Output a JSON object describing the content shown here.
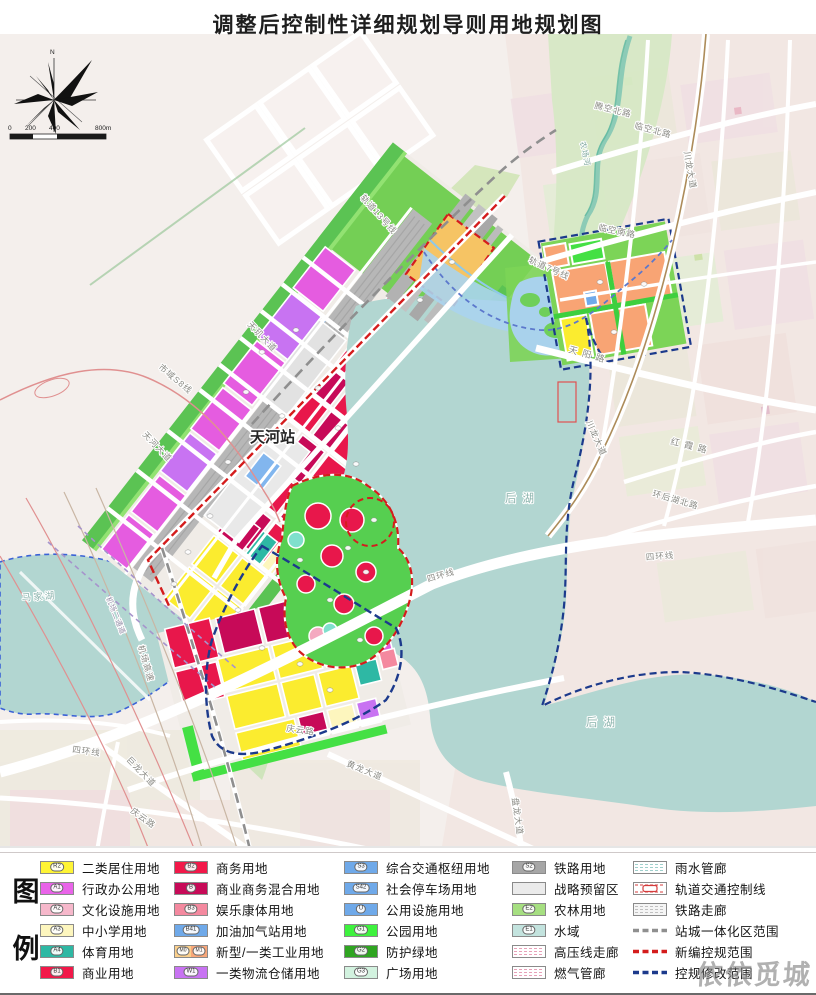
{
  "title": "调整后控制性详细规划导则用地规划图",
  "watermark": "依依觅城",
  "compass": {
    "north": "N"
  },
  "scale": {
    "ticks": [
      "0",
      "200",
      "400",
      "800m"
    ]
  },
  "map": {
    "labels": [
      {
        "t": "N",
        "x": 50,
        "y": 54,
        "r": 0,
        "c": "tick"
      },
      {
        "t": "0",
        "x": 8,
        "y": 130,
        "r": 0,
        "c": "tick"
      },
      {
        "t": "200",
        "x": 25,
        "y": 130,
        "r": 0,
        "c": "tick"
      },
      {
        "t": "400",
        "x": 49,
        "y": 130,
        "r": 0,
        "c": "tick"
      },
      {
        "t": "800m",
        "x": 95,
        "y": 130,
        "r": 0,
        "c": "tick"
      },
      {
        "t": "轨道13号线",
        "x": 360,
        "y": 198,
        "r": 48,
        "c": "road"
      },
      {
        "t": "天玑大道",
        "x": 247,
        "y": 325,
        "r": 46,
        "c": "road"
      },
      {
        "t": "市域S8线",
        "x": 158,
        "y": 368,
        "r": 40,
        "c": "road"
      },
      {
        "t": "天河大道",
        "x": 142,
        "y": 435,
        "r": 46,
        "c": "road"
      },
      {
        "t": "机场二通道",
        "x": 106,
        "y": 598,
        "r": 68,
        "c": "road-sm"
      },
      {
        "t": "机场高速",
        "x": 138,
        "y": 646,
        "r": 74,
        "c": "road"
      },
      {
        "t": "四环线",
        "x": 72,
        "y": 752,
        "r": 8,
        "c": "road"
      },
      {
        "t": "四环线",
        "x": 428,
        "y": 582,
        "r": -16,
        "c": "road"
      },
      {
        "t": "四环线",
        "x": 646,
        "y": 560,
        "r": -4,
        "c": "road"
      },
      {
        "t": "庆云路",
        "x": 286,
        "y": 731,
        "r": 8,
        "c": "road"
      },
      {
        "t": "庆云路",
        "x": 130,
        "y": 812,
        "r": 36,
        "c": "road"
      },
      {
        "t": "巨龙大道",
        "x": 126,
        "y": 760,
        "r": 46,
        "c": "road"
      },
      {
        "t": "黄龙大道",
        "x": 346,
        "y": 766,
        "r": 22,
        "c": "road"
      },
      {
        "t": "盘龙大道",
        "x": 512,
        "y": 798,
        "r": 82,
        "c": "road"
      },
      {
        "t": "腾空北路",
        "x": 594,
        "y": 108,
        "r": 14,
        "c": "road"
      },
      {
        "t": "临空北路",
        "x": 634,
        "y": 128,
        "r": 15,
        "c": "road"
      },
      {
        "t": "临空南路",
        "x": 598,
        "y": 230,
        "r": 12,
        "c": "road"
      },
      {
        "t": "农场河",
        "x": 580,
        "y": 142,
        "r": 78,
        "c": "stream"
      },
      {
        "t": "轨道7号线",
        "x": 528,
        "y": 262,
        "r": 24,
        "c": "road"
      },
      {
        "t": "川龙大道",
        "x": 684,
        "y": 152,
        "r": 80,
        "c": "road"
      },
      {
        "t": "川龙大道",
        "x": 586,
        "y": 422,
        "r": 66,
        "c": "road"
      },
      {
        "t": "天阳路",
        "x": 568,
        "y": 352,
        "r": 16,
        "c": "road-sp"
      },
      {
        "t": "红霞路",
        "x": 670,
        "y": 444,
        "r": 14,
        "c": "road-sp"
      },
      {
        "t": "环后湖北路",
        "x": 652,
        "y": 496,
        "r": 16,
        "c": "road"
      },
      {
        "t": "后湖",
        "x": 505,
        "y": 502,
        "r": 0,
        "c": "water"
      },
      {
        "t": "后湖",
        "x": 586,
        "y": 726,
        "r": 0,
        "c": "water"
      },
      {
        "t": "马家湖",
        "x": 22,
        "y": 601,
        "r": -4,
        "c": "water-sm"
      },
      {
        "t": "天河站",
        "x": 250,
        "y": 442,
        "r": 0,
        "c": "station"
      }
    ]
  },
  "legend": {
    "heading": [
      "图",
      "例"
    ],
    "columns": [
      {
        "items": [
          {
            "code": "R2",
            "label": "二类居住用地",
            "type": "solid",
            "color": "#fef435"
          },
          {
            "code": "A1",
            "label": "行政办公用地",
            "type": "solid",
            "color": "#e964e9"
          },
          {
            "code": "A2",
            "label": "文化设施用地",
            "type": "solid",
            "color": "#f6b8cb"
          },
          {
            "code": "A3",
            "label": "中小学用地",
            "type": "solid",
            "color": "#fdf6be"
          },
          {
            "code": "A4",
            "label": "体育用地",
            "type": "solid",
            "color": "#2eb8a4"
          },
          {
            "code": "B1",
            "label": "商业用地",
            "type": "solid",
            "color": "#f21849"
          }
        ]
      },
      {
        "items": [
          {
            "code": "B2",
            "label": "商务用地",
            "type": "solid",
            "color": "#f21849"
          },
          {
            "code": "B",
            "label": "商业商务混合用地",
            "type": "solid",
            "color": "#c70a58"
          },
          {
            "code": "B3",
            "label": "娱乐康体用地",
            "type": "solid",
            "color": "#f4899f"
          },
          {
            "code": "B41",
            "label": "加油加气站用地",
            "type": "solid",
            "color": "#6fa9e9"
          },
          {
            "code": "M0",
            "code2": "M1",
            "label": "新型/一类工业用地",
            "type": "dual",
            "color": "#fbd08c",
            "color2": "#f9a77a"
          },
          {
            "code": "W1",
            "label": "一类物流仓储用地",
            "type": "solid",
            "color": "#c873f2"
          }
        ]
      },
      {
        "items": [
          {
            "code": "S3",
            "label": "综合交通枢纽用地",
            "type": "solid",
            "color": "#6fa9e9"
          },
          {
            "code": "S42",
            "label": "社会停车场用地",
            "type": "solid",
            "color": "#6fa9e9"
          },
          {
            "code": "U",
            "label": "公用设施用地",
            "type": "solid",
            "color": "#6fa9e9"
          },
          {
            "code": "G1",
            "label": "公园用地",
            "type": "solid",
            "color": "#3ef23e"
          },
          {
            "code": "G2",
            "label": "防护绿地",
            "type": "solid",
            "color": "#2fa521"
          },
          {
            "code": "G3",
            "label": "广场用地",
            "type": "solid",
            "color": "#d2f2df"
          }
        ]
      },
      {
        "items": [
          {
            "code": "S2",
            "label": "铁路用地",
            "type": "solid",
            "color": "#a6a6a6"
          },
          {
            "code": "",
            "label": "战略预留区",
            "type": "solid",
            "color": "#ebebeb"
          },
          {
            "code": "E2",
            "label": "农林用地",
            "type": "solid",
            "color": "#a6df81"
          },
          {
            "code": "E1",
            "label": "水域",
            "type": "solid",
            "color": "#c3e3de"
          },
          {
            "code": "",
            "label": "高压线走廊",
            "type": "corridor",
            "color": "#e8a0b8"
          },
          {
            "code": "",
            "label": "燃气管廊",
            "type": "corridor",
            "color": "#e8a0b8"
          }
        ]
      },
      {
        "items": [
          {
            "code": "",
            "label": "雨水管廊",
            "type": "corridor",
            "color": "#9fd0cc"
          },
          {
            "code": "",
            "label": "轨道交通控制线",
            "type": "railctl",
            "color": "#d43c3c"
          },
          {
            "code": "",
            "label": "铁路走廊",
            "type": "corridor-gray",
            "color": "#c0c0c0"
          },
          {
            "code": "",
            "label": "站城一体化区范围",
            "type": "dashline",
            "color": "#8f8f8f"
          },
          {
            "code": "",
            "label": "新编控规范围",
            "type": "dashline",
            "color": "#d41c1c"
          },
          {
            "code": "",
            "label": "控规修改范围",
            "type": "dashline",
            "color": "#1c3a8c"
          }
        ]
      }
    ]
  }
}
